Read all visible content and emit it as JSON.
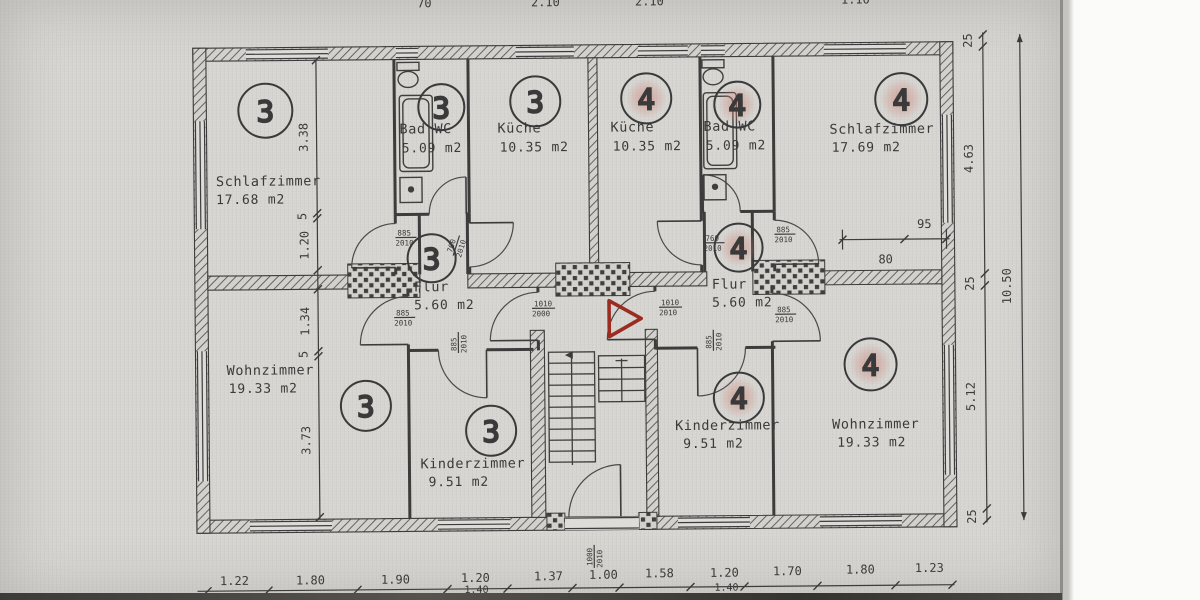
{
  "units": {
    "left": "3",
    "right": "4"
  },
  "rooms": {
    "schlaf3": {
      "name": "Schlafzimmer",
      "area": "17.68 m2"
    },
    "bad3": {
      "name": "Bad WC",
      "area": "5.09 m2"
    },
    "kueche3": {
      "name": "Küche",
      "area": "10.35 m2"
    },
    "flur3": {
      "name": "Flur",
      "area": "5.60 m2"
    },
    "wohn3": {
      "name": "Wohnzimmer",
      "area": "19.33 m2"
    },
    "kinder3": {
      "name": "Kinderzimmer",
      "area": "9.51 m2"
    },
    "kueche4": {
      "name": "Küche",
      "area": "10.35 m2"
    },
    "bad4": {
      "name": "Bad WC",
      "area": "5.09 m2"
    },
    "schlaf4": {
      "name": "Schlafzimmer",
      "area": "17.69 m2"
    },
    "flur4": {
      "name": "Flur",
      "area": "5.60 m2"
    },
    "kinder4": {
      "name": "Kinderzimmer",
      "area": "9.51 m2"
    },
    "wohn4": {
      "name": "Wohnzimmer",
      "area": "19.33 m2"
    }
  },
  "dims": {
    "bottom": [
      "1.22",
      "1.80",
      "1.90",
      "1.20",
      "1.37",
      "1.00",
      "1.58",
      "1.20",
      "1.70",
      "1.80",
      "1.23"
    ],
    "bottom_sub": [
      "1.40",
      "1.40"
    ],
    "top_partial": [
      "70",
      "2.10",
      "2.10",
      "1.10"
    ],
    "right_chain": [
      "25",
      "4.63",
      "25",
      "5.12",
      "25"
    ],
    "right_total": "10.50",
    "left_chain_upper": [
      "3.38",
      "5",
      "1.20"
    ],
    "left_chain_lower": [
      "1.34",
      "5",
      "3.73"
    ],
    "w95": "95",
    "w80": "80"
  },
  "doors": {
    "d885": {
      "w": "885",
      "h": "2010"
    },
    "d760": {
      "w": "760",
      "h": "2010"
    },
    "d1010a": {
      "w": "1010",
      "h": "2000"
    },
    "d1010b": {
      "w": "1010",
      "h": "2010"
    },
    "d1000": {
      "w": "1000",
      "h": "2010"
    }
  },
  "colors": {
    "paper": "#d7d6d2",
    "ink": "#3a3a3a",
    "marker_red": "#9c2c20",
    "highlight_pink": "#d08a80"
  }
}
